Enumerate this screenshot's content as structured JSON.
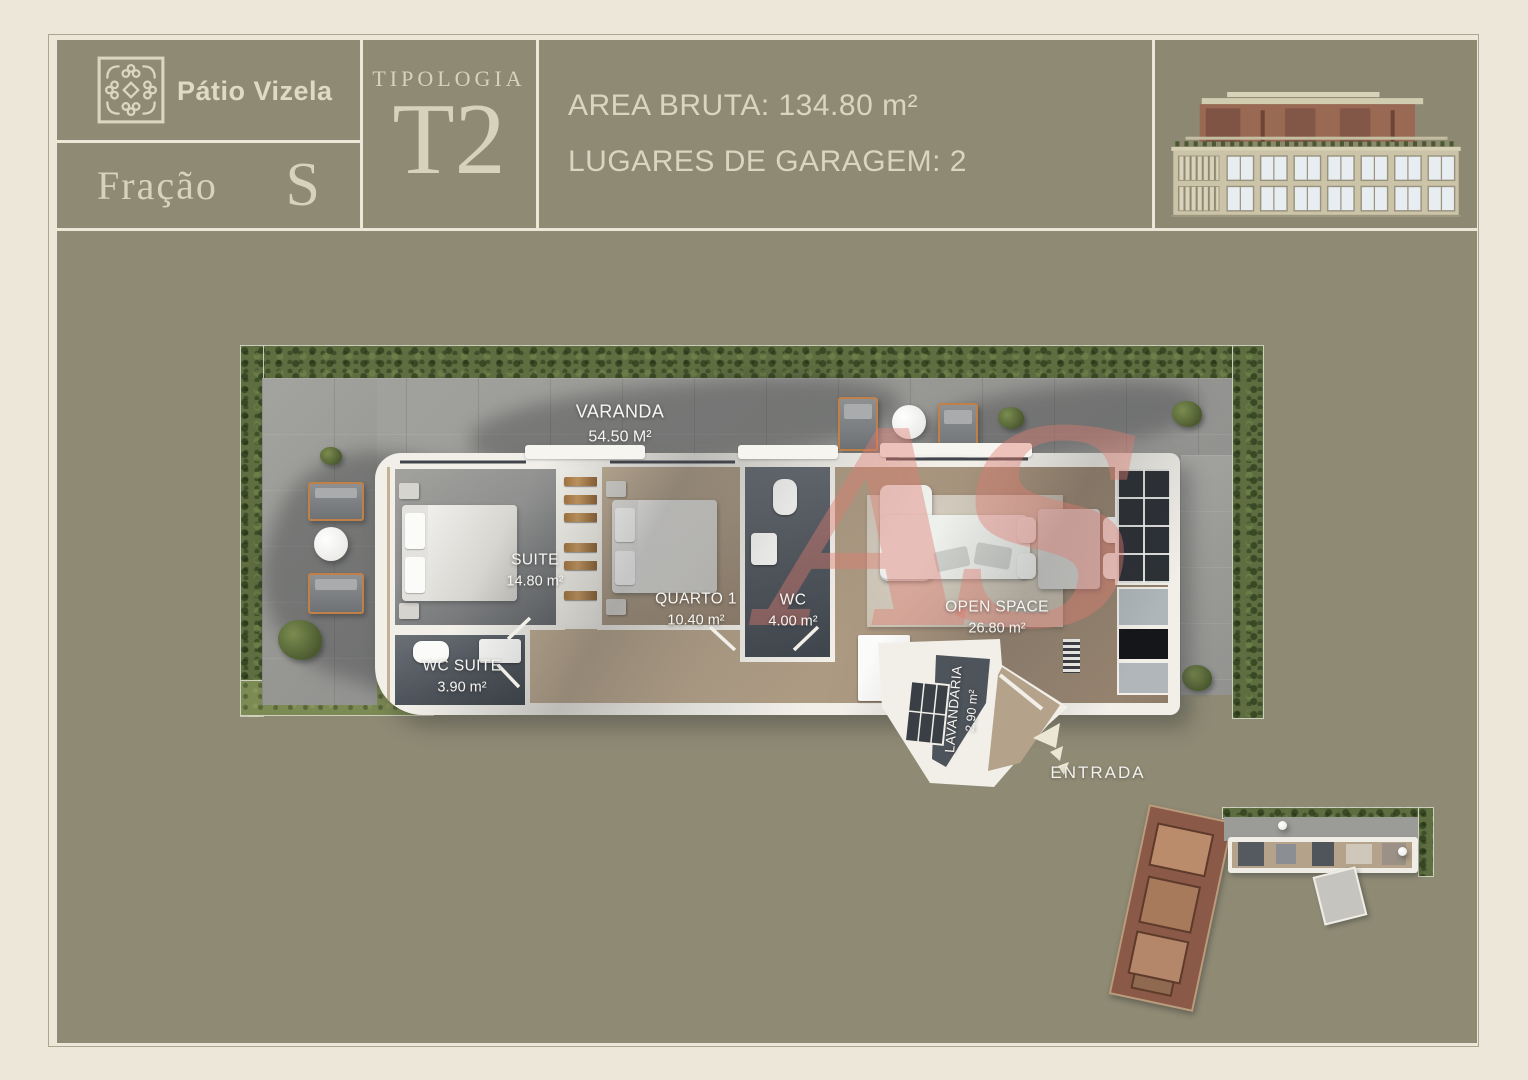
{
  "header": {
    "brand": "Pátio Vizela",
    "fraction": {
      "label": "Fração",
      "value": "S"
    },
    "typology": {
      "label": "TIPOLOGIA",
      "value": "T2"
    },
    "specs": {
      "area": "AREA BRUTA: 134.80 m²",
      "garage": "LUGARES DE GARAGEM: 2"
    }
  },
  "plan": {
    "varanda": {
      "name": "VARANDA",
      "area": "54.50 M²"
    },
    "suite": {
      "name": "SUITE",
      "area": "14.80 m²"
    },
    "wc_suite": {
      "name": "WC SUITE",
      "area": "3.90 m²"
    },
    "quarto1": {
      "name": "QUARTO 1",
      "area": "10.40 m²"
    },
    "wc": {
      "name": "WC",
      "area": "4.00 m²"
    },
    "open_space": {
      "name": "OPEN SPACE",
      "area": "26.80 m²"
    },
    "lavandaria": {
      "name": "LAVANDARIA",
      "area": "2.90 m²"
    },
    "entrance": "ENTRADA",
    "watermark": "AS"
  },
  "colors": {
    "page_bg": "#EDE7D9",
    "panel_bg": "#8E8A74",
    "header_text": "#DBD5C0",
    "label_text": "#F7F6F2",
    "hedge_green": "#5E6E40",
    "grass_green": "#7C8A54",
    "terrace_gray": "#9D9D99",
    "wall_white": "#F1EFE8",
    "wood_floor": "#B7A68E",
    "dark_floor": "#4E545B",
    "building_brown": "#9A6953",
    "watermark_pink": "#E07D70"
  }
}
